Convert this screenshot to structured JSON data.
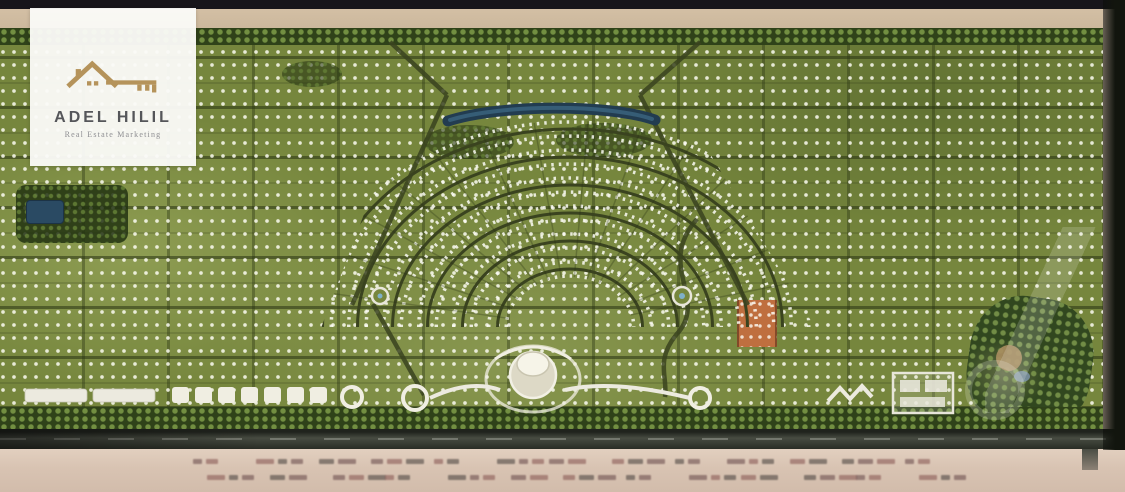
{
  "brand_card": {
    "name": "ADEL HILIL",
    "tagline": "Real Estate Marketing"
  },
  "colors": {
    "top_bar": "#17151a",
    "right_band": "#12150e",
    "sand": "#d8c3b2",
    "sand_light": "#e2cfbf",
    "plan_green": "#76863d",
    "road_dark": "#3a431f",
    "tree_green": "#2f4219",
    "lagoon_blue": "#2a4a63",
    "highlight_plot": "#bf6f3f",
    "logo_gold": "#b5935a",
    "highway": "#44483e",
    "white_bld": "#efede0"
  },
  "bottom_legend": {
    "legible": false,
    "rows": 2,
    "groups": 13,
    "mark_color_a": "#6d4f4f",
    "mark_color_b": "#8a5a56",
    "mark_color_c": "#4f4743"
  },
  "fan": {
    "center_x": 570,
    "center_y": 318,
    "ring_ry": [
      58,
      86,
      114,
      142,
      170,
      198
    ],
    "rx_ratio": 1.25,
    "spoke_step_deg": 12
  }
}
